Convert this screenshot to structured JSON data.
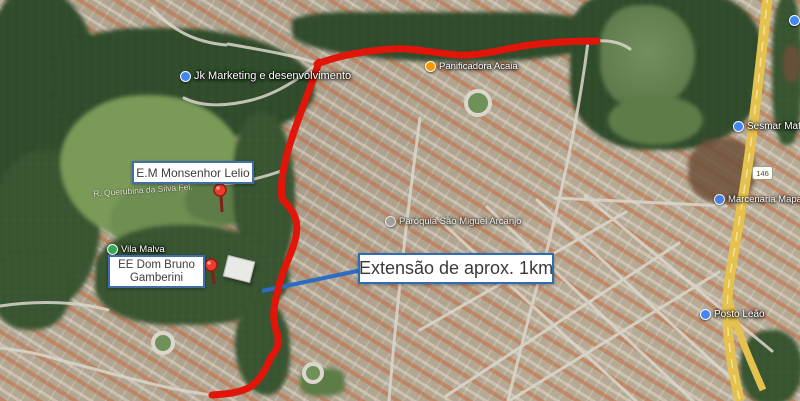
{
  "annotations": {
    "school1_label": "E.M Monsenhor Lelio",
    "school2_line1": "EE Dom Bruno",
    "school2_line2": "Gamberini",
    "extension_label": "Extensão de aprox. 1km"
  },
  "pois": [
    {
      "name": "Jk Marketing e desenvolvimento",
      "color": "#4285f4"
    },
    {
      "name": "Panificadora Acaia",
      "color": "#f29900"
    },
    {
      "name": "Marcenaria Mapa Leilões",
      "color": "#4285f4"
    },
    {
      "name": "Sesmar Mater",
      "color": "#4285f4"
    },
    {
      "name": "Vila Malva",
      "color": "#34a853"
    },
    {
      "name": "Paróquia São Miguel Arcanjo",
      "color": "#9aa0a6"
    },
    {
      "name": "Posto Leão",
      "color": "#4285f4"
    }
  ],
  "streets": [
    {
      "name": "R. Querubina da Silva Fel."
    }
  ],
  "road_shield": "146",
  "colors": {
    "route_highlight": "#e2150a",
    "measure_line": "#2b6cc4",
    "annotation_border": "#3f6ea8",
    "highway": "#e5c14d"
  }
}
